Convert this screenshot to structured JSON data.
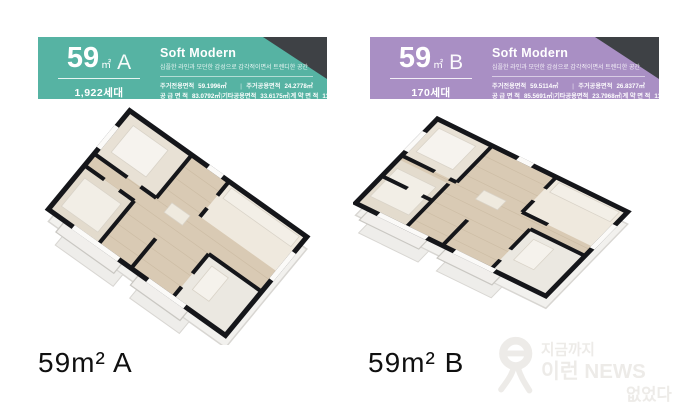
{
  "ui": {
    "divider": "|"
  },
  "cards": [
    {
      "header": {
        "size": "59",
        "unit": "㎡",
        "type": "A",
        "households": "1,922세대",
        "concept_title": "Soft Modern",
        "concept_subtitle": "심플한 라인과 모던한 감성으로 감각적이면서 트렌디한 공간",
        "accent": "#56b3a3",
        "corner": "#3e4145"
      },
      "specs": {
        "r1c1_label": "주거전용면적",
        "r1c1_value": "59.1996㎡",
        "r1c2_label": "주거공용면적",
        "r1c2_value": "24.2778㎡",
        "r2c1_label": "공 급 면 적",
        "r2c1_value": "83.0792㎡",
        "r2c2_label": "기타공용면적",
        "r2c2_value": "33.6175㎡",
        "r2c3_label": "계 약 면 적",
        "r2c3_value": "117.1947㎡"
      },
      "caption": "59m² A"
    },
    {
      "header": {
        "size": "59",
        "unit": "㎡",
        "type": "B",
        "households": "170세대",
        "concept_title": "Soft Modern",
        "concept_subtitle": "심플한 라인과 모던한 감성으로 감각적이면서 트렌디한 공간",
        "accent": "#a98fc4",
        "corner": "#3e4145"
      },
      "specs": {
        "r1c1_label": "주거전용면적",
        "r1c1_value": "59.5114㎡",
        "r1c2_label": "주거공용면적",
        "r1c2_value": "26.8377㎡",
        "r2c1_label": "공 급 면 적",
        "r2c1_value": "85.5691㎡",
        "r2c2_label": "기타공용면적",
        "r2c2_value": "23.7968㎡",
        "r2c3_label": "계 약 면 적",
        "r2c3_value": "117.3696㎡"
      },
      "caption": "59m² B"
    }
  ],
  "watermark": {
    "line1": "지금까지",
    "line2": "이런 NEWS",
    "line3": "없었다"
  }
}
